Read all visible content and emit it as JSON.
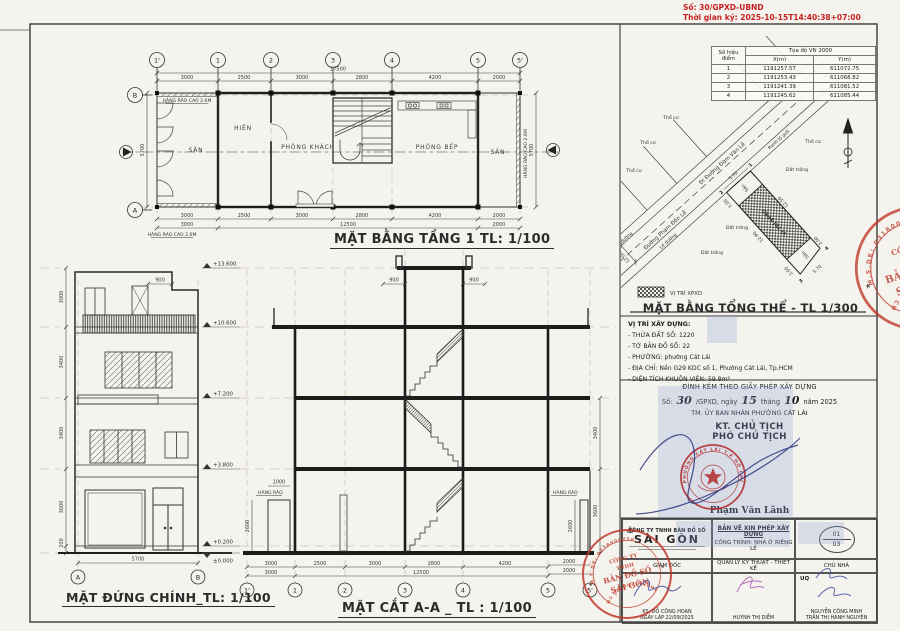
{
  "page": {
    "doc_no": "Số: 30/GPXD-UBND",
    "signed_time": "Thời gian ký: 2025-10-15T14:40:38+07:00"
  },
  "coord_table": {
    "title": "Tọa độ VN 2000",
    "col_point": "Số hiệu điểm",
    "col_x": "X(m)",
    "col_y": "Y(m)",
    "rows": [
      {
        "p": "1",
        "x": "1191257.57",
        "y": "611072.75"
      },
      {
        "p": "2",
        "x": "1191253.43",
        "y": "611068.82"
      },
      {
        "p": "3",
        "x": "1191241.39",
        "y": "611081.52"
      },
      {
        "p": "4",
        "x": "1191245.62",
        "y": "611085.44"
      }
    ]
  },
  "site_plan": {
    "title": "MẶT BẰNG TỔNG THỂ - TL 1/300",
    "legend_label": "VỊ TRÍ XPXD",
    "plot_label": "VỊ TRÍ XPXD",
    "road_name": "Đường Phạm Đôn Lễ",
    "road_dir": "Đi Đường Đàm Văn Lễ",
    "boundary_label": "Ranh lộ giới",
    "sidewalk_label": "Lề đường",
    "parcel_label": "Thổ cư",
    "empty_label": "Đất trống",
    "yard_label": "Sân",
    "road_width": "12.00",
    "dims": {
      "front_w": "5.70",
      "front_d": "3.00",
      "side_right": "12.50",
      "side_left": "12.90",
      "rear_w": "5.70",
      "rear_d_left": "3.00",
      "rear_d_right": "2.00"
    },
    "points": {
      "p1": "1",
      "p2": "2",
      "p3": "3",
      "p4": "4"
    }
  },
  "location": {
    "heading": "VỊ TRÍ XÂY DỰNG:",
    "lines": [
      "- THỬA ĐẤT SỐ: 1220",
      "- TỜ BẢN ĐỒ SỐ: 22",
      "- PHƯỜNG: phường Cát Lái",
      "- ĐỊA CHỈ: Nền G29 KDC số 1, Phường Cát Lái, Tp.HCM",
      "- DIỆN TÍCH KHUÔN VIÊN: 59.8m²"
    ]
  },
  "permit": {
    "heading": "ĐÍNH KÈM THEO GIẤY PHÉP XÂY DỰNG",
    "no_prefix": "Số:",
    "no_value": "30",
    "no_mid": "/GPXD, ngày",
    "day": "15",
    "month_label": "tháng",
    "month": "10",
    "year_label": "năm 2025",
    "authority": "TM. ỦY BAN NHÂN PHƯỜNG CÁT LÁI",
    "kt": "KT. CHỦ TỊCH",
    "title_line": "PHÓ CHỦ TỊCH",
    "signer": "Phạm Văn Lãnh",
    "seal_ring": "PHƯỜNG CÁT LÁI T.P HỒ CHÍ MINH"
  },
  "title_block": {
    "company_line1": "CÔNG TY TNHH BẢN ĐỒ SỐ",
    "company_line2": "SÀI GÒN",
    "doc_type": "BẢN VẼ XIN PHÉP XÂY DỰNG",
    "project": "CÔNG TRÌNH: NHÀ Ở RIÊNG LẺ",
    "sheet_no": "01",
    "sheet_total": "03",
    "role_director": "GIÁM ĐỐC",
    "role_tech": "QUẢN LÝ KỸ THUẬT - THIẾT KẾ",
    "role_owner": "CHỦ NHÀ",
    "sig_director_name": "KS. ĐỖ CÔNG HOAN",
    "sig_date": "NGÀY LẬP 22/09/2025",
    "sig_tech_name": "HUỲNH THỊ DIỄM",
    "uq": "UQ",
    "owner_name1": "NGUYỄN CÔNG MINH",
    "owner_name2": "TRẦN THỊ HẠNH NGUYÊN"
  },
  "company_stamp": {
    "center1": "CÔNG TY",
    "center2": "TNHH",
    "center3": "BẢN ĐỒ SỐ",
    "center4": "SÀI GÒN",
    "ring_top": "M.S.DK: 0318009756",
    "ring_bottom": "THÀNH PHỐ HỒ CHÍ MINH"
  },
  "floor_plan": {
    "title": "MẶT BẰNG TẦNG 1 TL: 1/100",
    "grids": [
      "1'",
      "1",
      "2",
      "3",
      "4",
      "5",
      "5'"
    ],
    "row_a": "A",
    "row_b": "B",
    "total": "17500",
    "dims_top": [
      "3000",
      "2500",
      "3000",
      "2800",
      "4200",
      "2000"
    ],
    "dims_bot": [
      "3000",
      "2500",
      "3000",
      "2800",
      "4200",
      "2000"
    ],
    "dims_bot2": [
      "3000",
      "12500",
      "2000"
    ],
    "side_dim": "5700",
    "fence_label": "HÀNG RÀO CAO 2.6M",
    "rooms": {
      "san": "SÂN",
      "hien": "HIÊN",
      "khach": "PHÒNG KHÁCH",
      "bep": "PHÒNG BẾP",
      "san2": "SÂN"
    }
  },
  "elevation": {
    "title": "MẶT ĐỨNG CHÍNH_TL: 1/100",
    "levels": [
      "+13.600",
      "+10.600",
      "+7.200",
      "+3.800",
      "+0.200",
      "±0.000"
    ],
    "dims_left": [
      "3000",
      "3400",
      "3400",
      "3600",
      "200"
    ],
    "dim_900": "900",
    "dim_bottom": "5700",
    "grid_a": "A",
    "grid_b": "B"
  },
  "section": {
    "title": "MẶT CẮT A-A _ TL : 1/100",
    "dims_900": [
      "900",
      "900"
    ],
    "dims_bot": [
      "3000",
      "2500",
      "3000",
      "2800",
      "4200"
    ],
    "dims_bot2": [
      "3000",
      "12500"
    ],
    "dims_right": [
      "3400",
      "3600"
    ],
    "dims_right2": [
      "2000",
      "2000"
    ],
    "fence_label": "HÀNG RÀO",
    "fence_height": "2600",
    "dim_1000": "1000"
  }
}
